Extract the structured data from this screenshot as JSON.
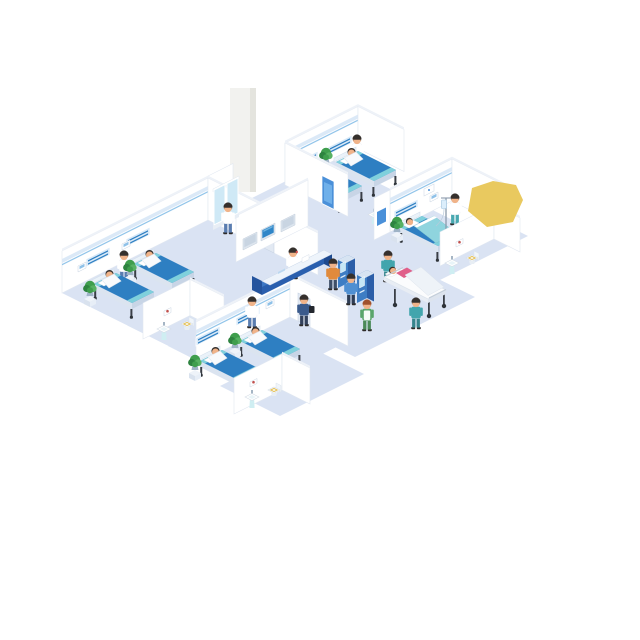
{
  "figure": {
    "title": "Hospital ward floor — isometric cutaway illustration",
    "description": "Isometric cutaway of a hospital ward: four patient rooms with blue beds and seated patients, en-suite bathrooms with pedestal sinks and toilets, a central reception desk with a navy sign band and three wall displays (one lit blue), a glass medicine cabinet beside a tall column, two self-service check-in kiosks with users, staff and nurses in the corridor, an orderly moving a patient on a gurney, potted plants, and an irregular yellow highlight blob at the upper right."
  },
  "palette": {
    "floor": "#dae3f3",
    "wall": "#ffffff",
    "wall_cap": "#eef2f8",
    "wall_stroke": "#e2e8f1",
    "trim_band": "#dbe9f7",
    "trim_line": "#93c5ea",
    "panel": "#d8e9f8",
    "panel_stripe": "#2e7fc2",
    "bed_blue": "#2e7fc2",
    "bed_teal": "#7fd0dc",
    "bed_frame": "#dbe4f0",
    "desk_navy": "#24549e",
    "desk_band": "#3d77c4",
    "desk_top": "#eef4fb",
    "screen_on": "#2f86c8",
    "screen_off": "#c9d5e2",
    "kiosk_front": "#3e7dc4",
    "kiosk_side": "#2b5ea8",
    "kiosk_screen": "#c5e7f6",
    "cabinet_glass": "#cfe9f6",
    "plant": "#3f9e4d",
    "plant_dark": "#2e8340",
    "plant_light": "#57b163",
    "pot": "#9fb3c6",
    "door": "#e2e9f3",
    "door_blue": "#4a90d9",
    "fixture": "#cfeef2",
    "art_red": "#c0504d",
    "skin": "#f0b389",
    "hair": "#35302d",
    "scrub_teal": "#42a5ad",
    "scrub_green": "#5aa56b",
    "coat_white": "#ffffff",
    "pants_blue": "#5a7db0",
    "shirt_orange": "#e08a3c",
    "shirt_blue": "#4f8fd2",
    "jacket_navy": "#3a5a8c",
    "pants_navy": "#33415c",
    "patient_pink": "#e0608a",
    "metal": "#3a3f47",
    "highlight_yellow": "#e9c95f",
    "column": "#f2f2ef"
  },
  "scene": {
    "rooms": [
      {
        "id": "room-left",
        "type": "patient room",
        "beds": 2,
        "patients_in_bed": 2,
        "staff": [
          "nurse"
        ],
        "items": [
          "bed-head panels",
          "wall plaques",
          "potted plants",
          "en-suite bathroom"
        ]
      },
      {
        "id": "room-bottom",
        "type": "patient room",
        "beds": 2,
        "patients_in_bed": 2,
        "staff": [
          "nurse"
        ],
        "items": [
          "bed-head panels",
          "wall plaque",
          "potted plants",
          "en-suite bathroom",
          "door"
        ]
      },
      {
        "id": "room-top",
        "type": "patient room",
        "beds": 2,
        "patients_in_bed": 2,
        "staff": [
          "nurse"
        ],
        "items": [
          "bed-head panels",
          "wall plaque",
          "potted plant",
          "blue corridor door"
        ]
      },
      {
        "id": "room-right",
        "type": "patient room",
        "beds": 1,
        "patients_in_bed": 1,
        "staff": [
          "nurse"
        ],
        "items": [
          "IV drip stand",
          "wall device",
          "potted plant",
          "en-suite bathroom"
        ]
      }
    ],
    "bathrooms": [
      {
        "id": "bath-left",
        "fixtures": [
          "pedestal sink",
          "toilet",
          "framed wall picture"
        ]
      },
      {
        "id": "bath-bottom",
        "fixtures": [
          "pedestal sink",
          "toilet",
          "framed wall picture"
        ]
      },
      {
        "id": "bath-right",
        "fixtures": [
          "pedestal sink",
          "toilet",
          "framed wall picture"
        ]
      }
    ],
    "reception": {
      "desk": "U-shaped counter, navy front with lighter blue sign band and illegible white lettering",
      "staff": [
        "receptionist with phone"
      ],
      "wall_displays": {
        "count": 3,
        "active_blue": 1
      },
      "medicine_cabinet": true,
      "column": "tall white structural column rising above the ward"
    },
    "corridor": {
      "kiosks": 2,
      "kiosk_users": 2,
      "people": [
        "man walking with dark bag",
        "nurse in green uniform with white apron",
        "orderly in teal pushing gurney",
        "teal escort walking beside gurney"
      ],
      "gurney_patients": 1
    },
    "totals": {
      "people": 19,
      "beds_including_gurney": 7,
      "plants": 6,
      "sinks": 4,
      "toilets": 3
    },
    "highlight": {
      "shape": "irregular yellow polygon",
      "location": "upper right, overlapping the right room corner"
    }
  }
}
